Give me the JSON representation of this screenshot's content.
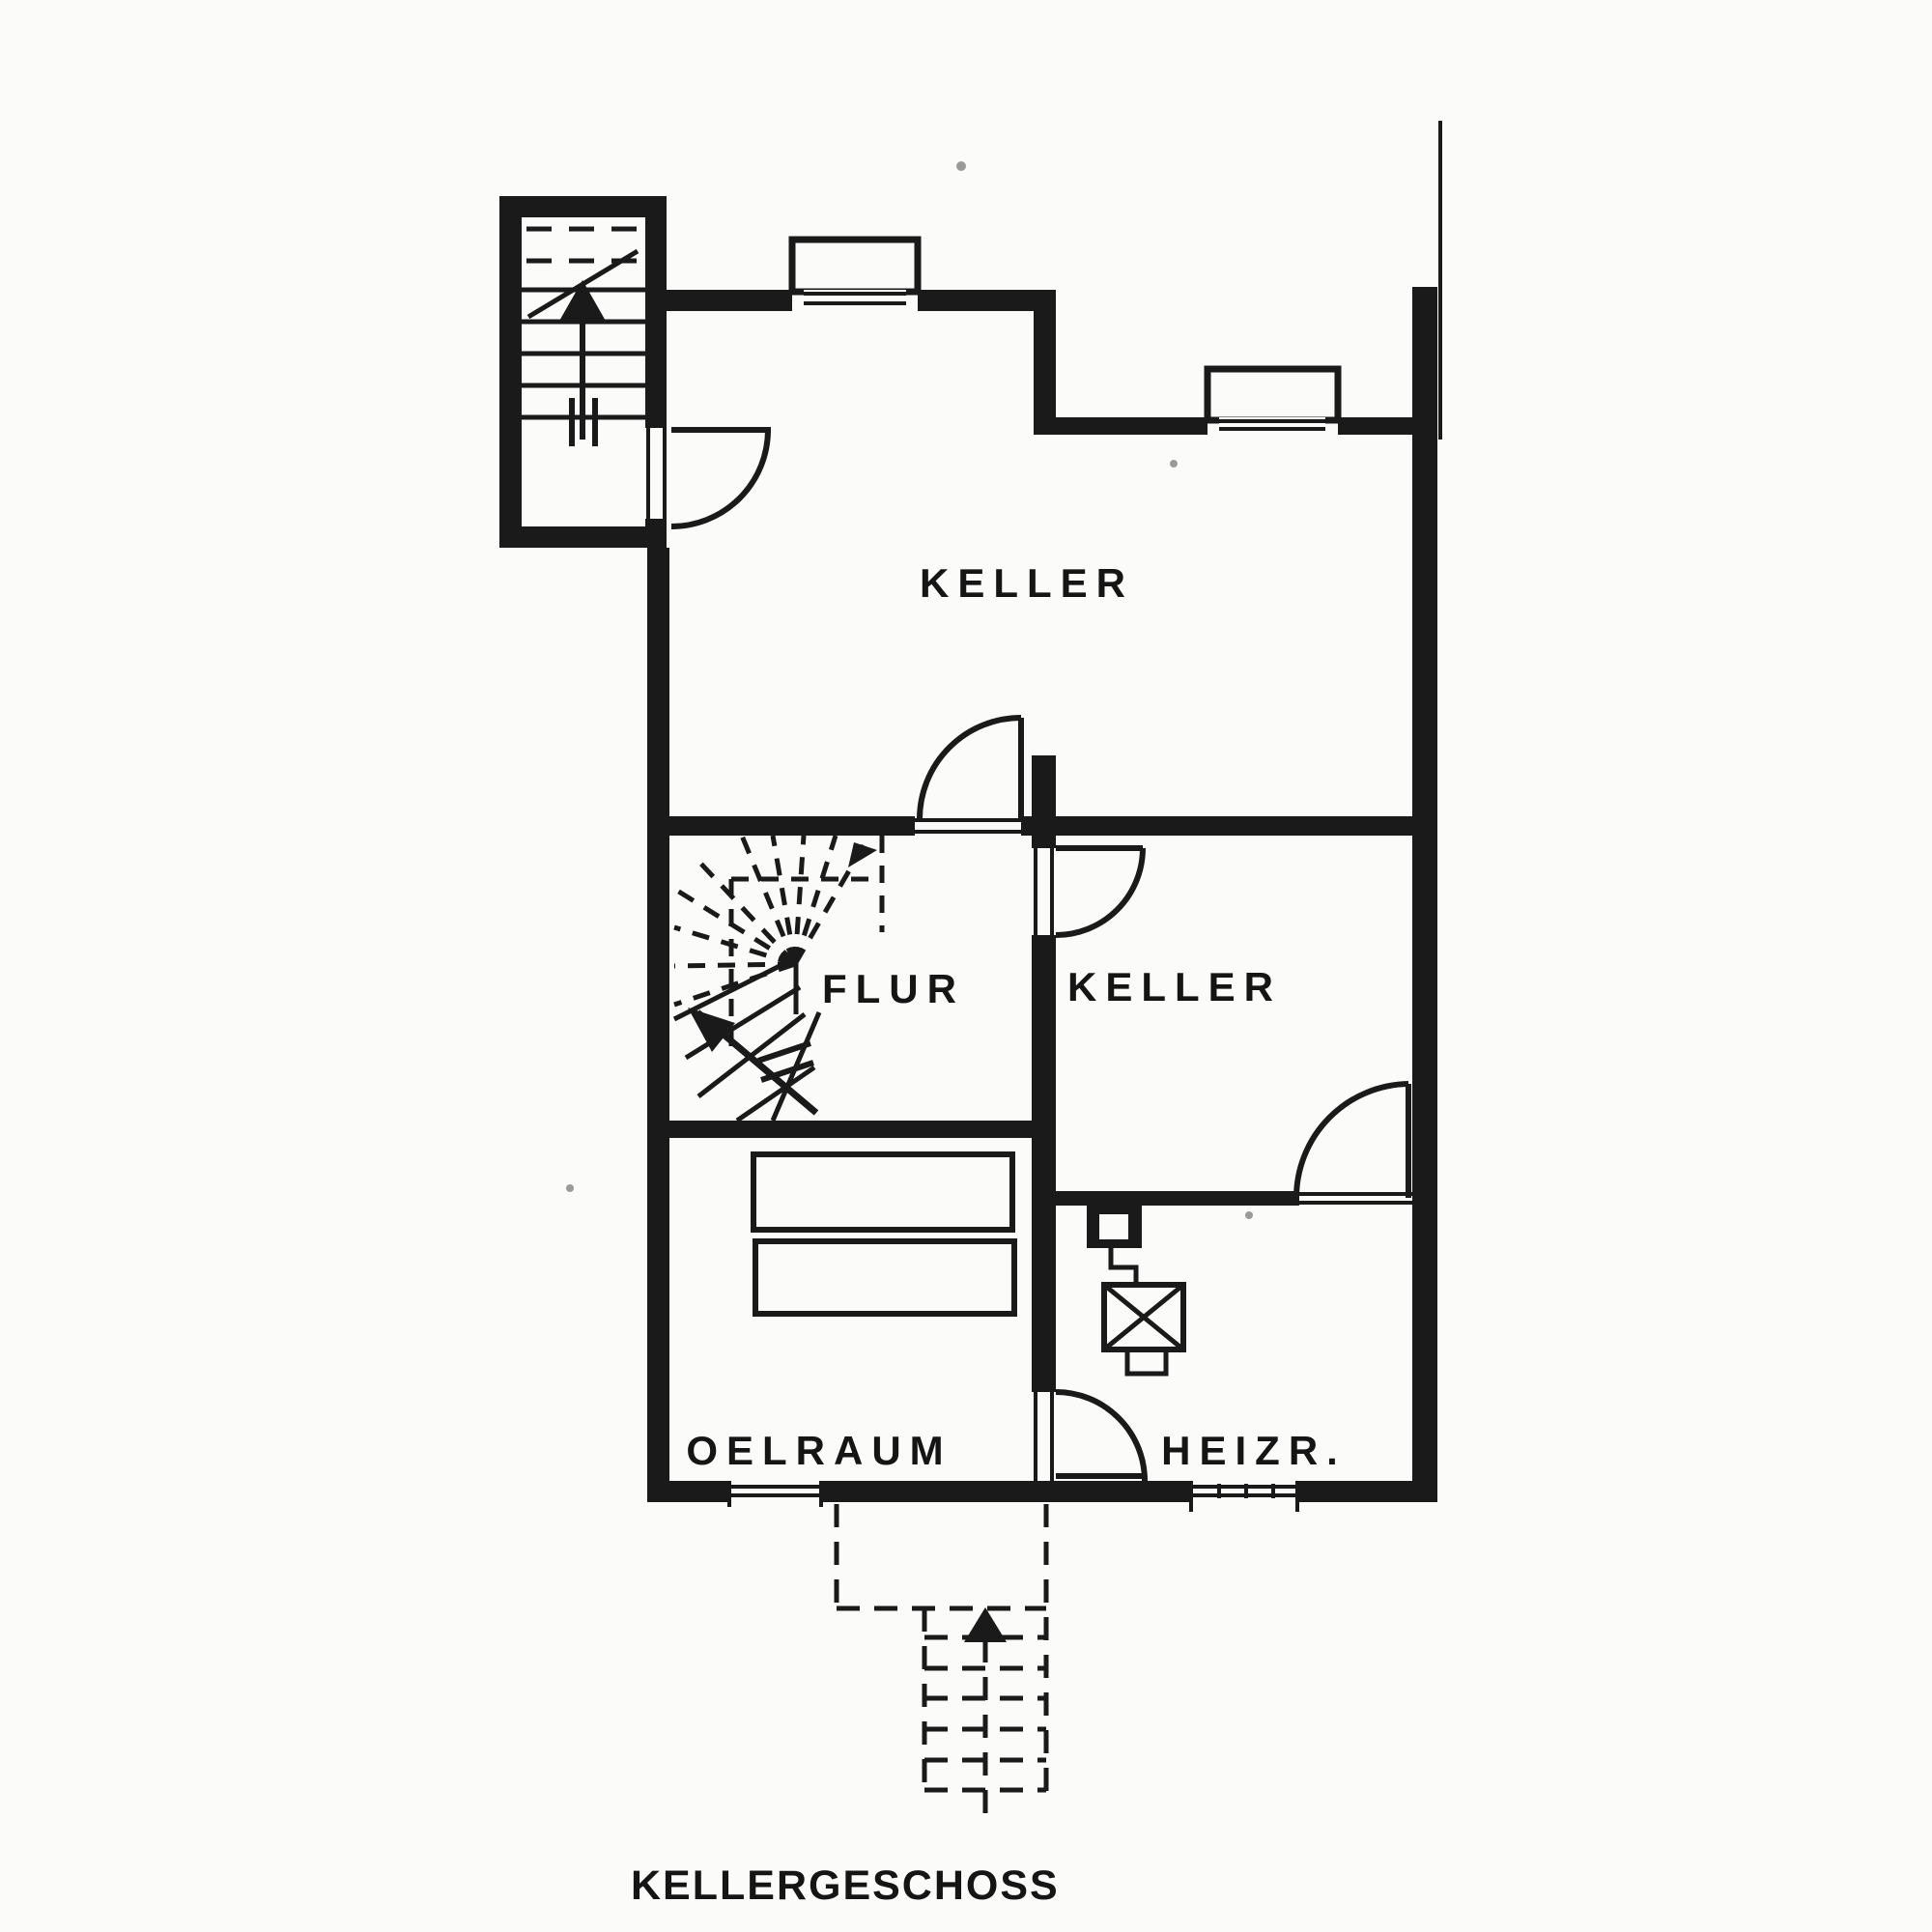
{
  "title": {
    "text": "KELLERGESCHOSS"
  },
  "rooms": [
    {
      "id": "keller-main",
      "label": "KELLER"
    },
    {
      "id": "flur",
      "label": "FLUR"
    },
    {
      "id": "keller-2",
      "label": "KELLER"
    },
    {
      "id": "oelraum",
      "label": "OELRAUM"
    },
    {
      "id": "heizraum",
      "label": "HEIZR."
    }
  ],
  "drawing": {
    "type": "basement floor plan (Kellergeschoss)",
    "ink_color": "#1a1a1a",
    "paper_color": "#fbfbf9",
    "stairs": [
      {
        "id": "entrance-stair-annex",
        "direction": "up",
        "style": "straight, sectioned with break line"
      },
      {
        "id": "winder-stair-flur",
        "direction": "up",
        "style": "quarter-turn winder, upper run dashed"
      },
      {
        "id": "exterior-cellar-stair",
        "direction": "up",
        "style": "dashed (outside, below grade)"
      }
    ],
    "doors": [
      {
        "id": "door-annex-to-keller"
      },
      {
        "id": "door-flur-to-keller-main"
      },
      {
        "id": "door-flur-to-keller-2"
      },
      {
        "id": "door-keller-2-to-heizraum"
      },
      {
        "id": "door-heizraum-to-oelraum-side"
      }
    ],
    "windows": [
      {
        "id": "window-keller-main-north"
      },
      {
        "id": "window-keller-main-east-step"
      },
      {
        "id": "window-oelraum-south"
      },
      {
        "id": "window-heizraum-south"
      }
    ],
    "equipment": [
      {
        "id": "oil-tank-1",
        "room": "OELRAUM"
      },
      {
        "id": "oil-tank-2",
        "room": "OELRAUM"
      },
      {
        "id": "chimney-flue",
        "room": "HEIZR."
      },
      {
        "id": "boiler",
        "room": "HEIZR."
      }
    ]
  }
}
